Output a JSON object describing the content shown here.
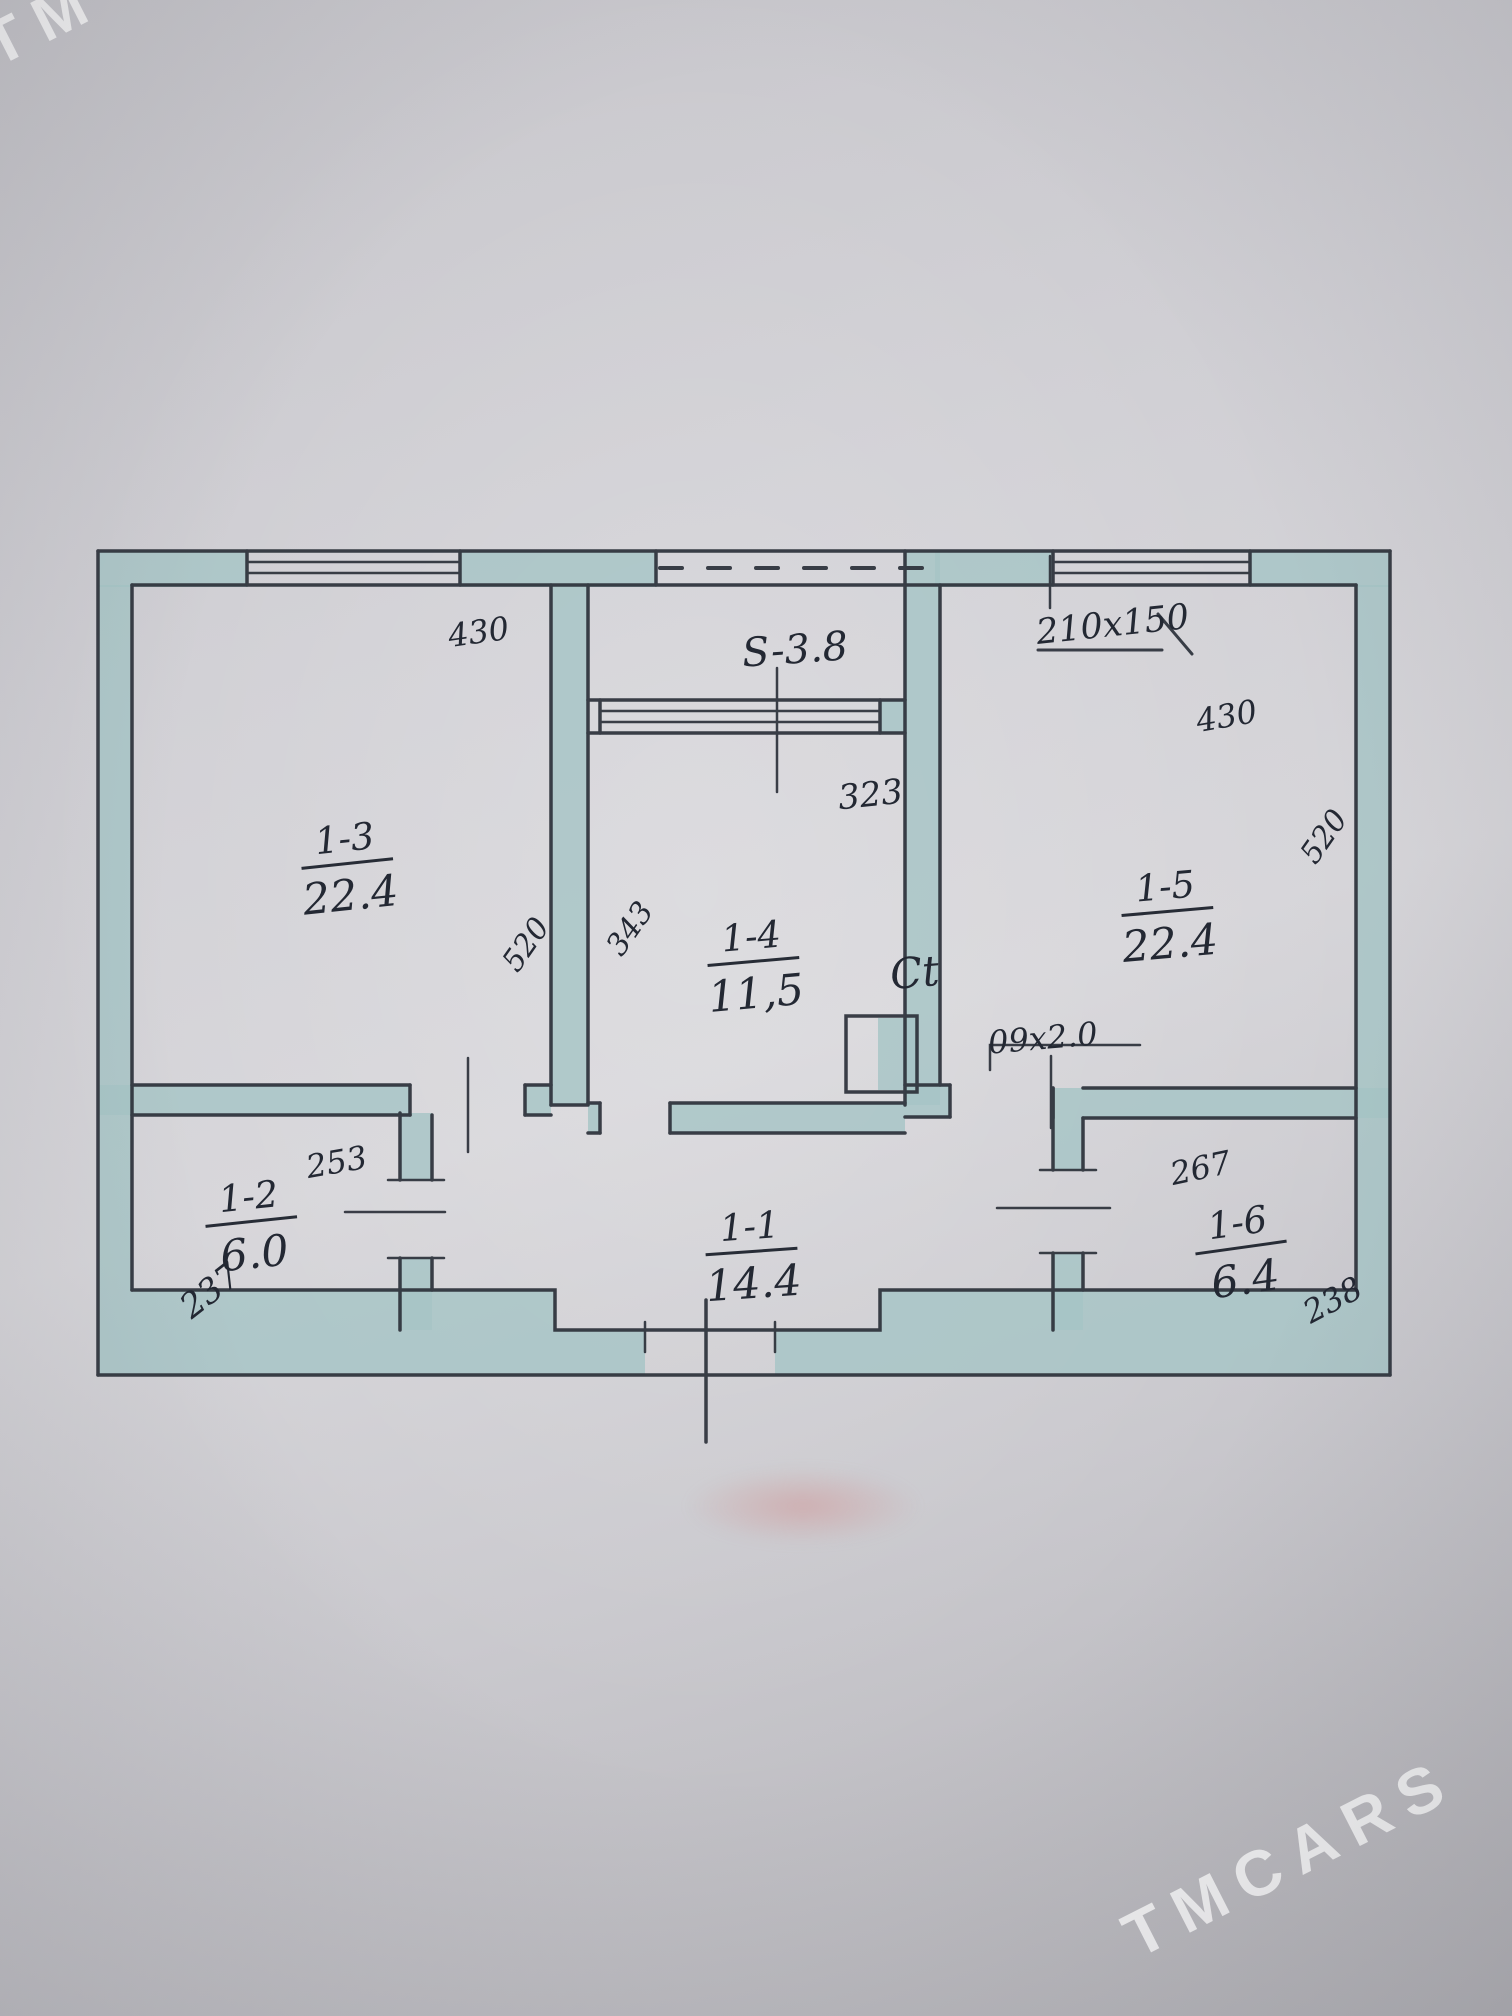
{
  "watermarks": {
    "top_left": "TM",
    "bottom_right": "TMCARS"
  },
  "rooms": {
    "r11": {
      "id": "1-1",
      "area": "14.4"
    },
    "r12": {
      "id": "1-2",
      "area": "6.0"
    },
    "r13": {
      "id": "1-3",
      "area": "22.4"
    },
    "r14": {
      "id": "1-4",
      "area": "11,5"
    },
    "r15": {
      "id": "1-5",
      "area": "22.4"
    },
    "r16": {
      "id": "1-6",
      "area": "6.4"
    }
  },
  "balcony": {
    "label": "S-3.8"
  },
  "dims": {
    "top_left_430": "430",
    "balcony_323": "323",
    "window_210x150": "210x150",
    "top_right_430": "430",
    "left_520": "520",
    "mid_343": "343",
    "right_520": "520",
    "door_09x20": "09x2.0",
    "d253": "253",
    "d237": "237",
    "d267": "267",
    "d238": "238"
  },
  "symbols": {
    "vent": "Ct"
  },
  "colors": {
    "wall_fill": "#a6c4c6",
    "pencil": "#2d323b",
    "paper": "#d0cfd4"
  }
}
